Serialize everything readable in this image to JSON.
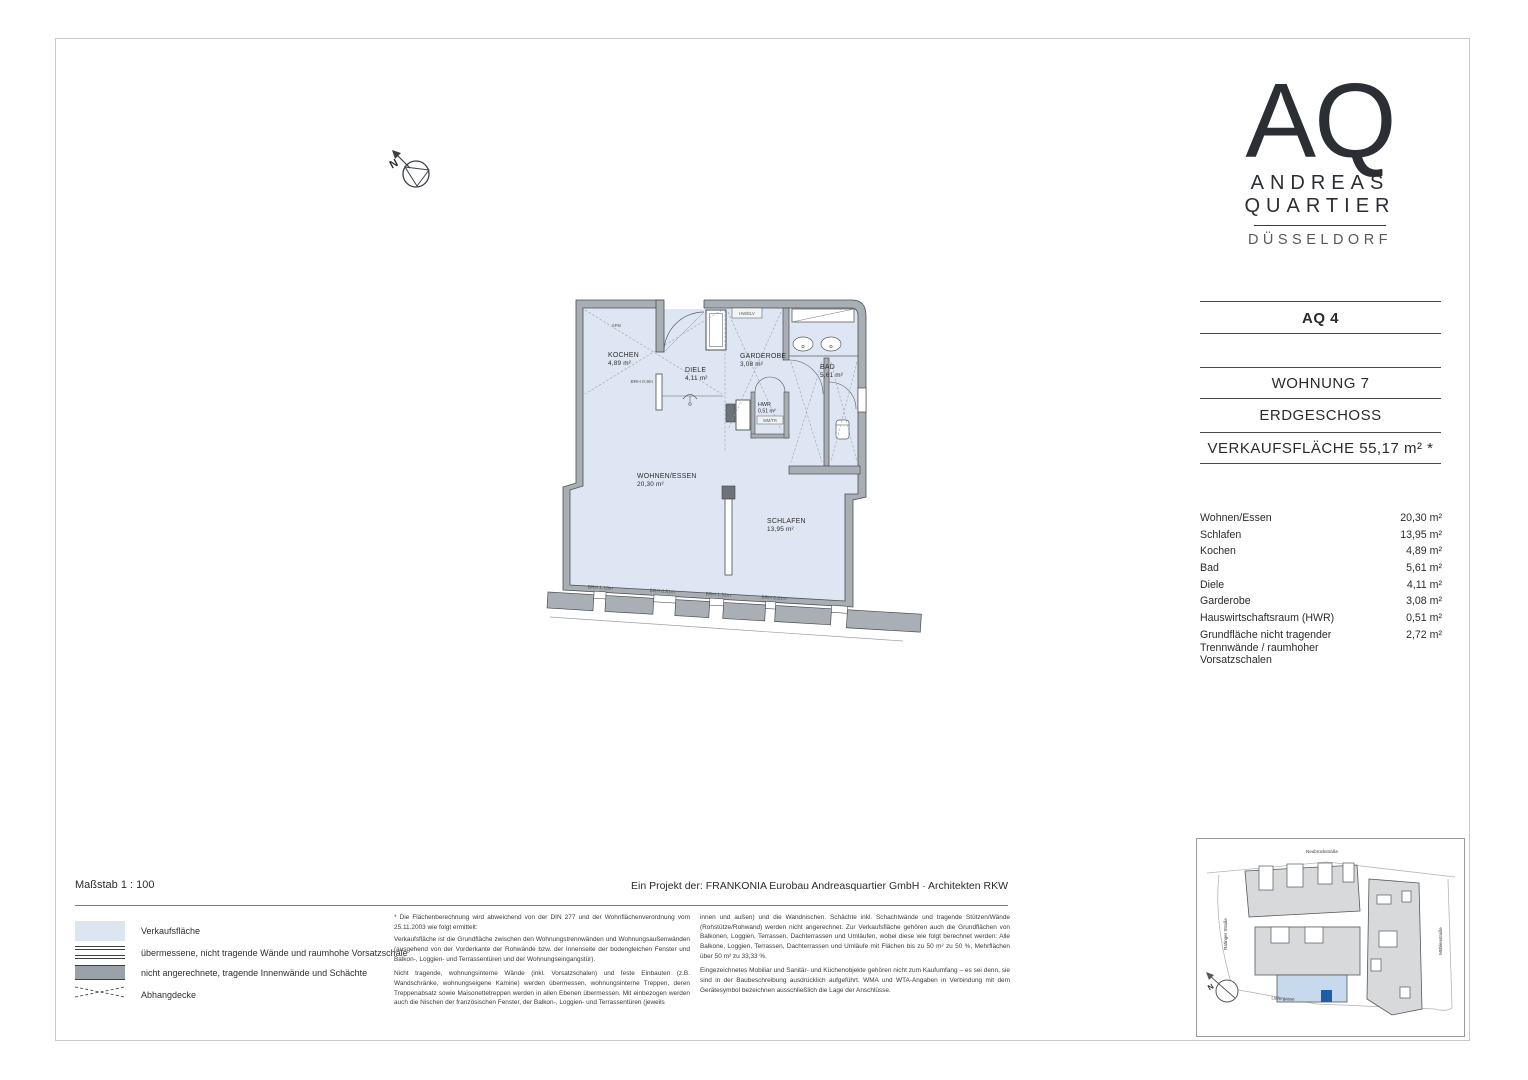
{
  "document": {
    "scale_label": "Maßstab 1 : 100",
    "project_credit": "Ein Projekt der: FRANKONIA Eurobau Andreasquartier GmbH · Architekten RKW"
  },
  "logo": {
    "monogram": "AQ",
    "name_line1": "ANDREAS",
    "name_line2": "QUARTIER",
    "city": "DÜSSELDORF"
  },
  "title_block": {
    "building": "AQ 4",
    "unit": "WOHNUNG 7",
    "floor": "ERDGESCHOSS",
    "sales_area": "VERKAUFSFLÄCHE 55,17 m² *"
  },
  "room_table": {
    "rows": [
      {
        "label": "Wohnen/Essen",
        "value": "20,30 m²"
      },
      {
        "label": "Schlafen",
        "value": "13,95 m²"
      },
      {
        "label": "Kochen",
        "value": "4,89 m²"
      },
      {
        "label": "Bad",
        "value": "5,61 m²"
      },
      {
        "label": "Diele",
        "value": "4,11 m²"
      },
      {
        "label": "Garderobe",
        "value": "3,08 m²"
      },
      {
        "label": "Hauswirtschaftsraum (HWR)",
        "value": "0,51 m²"
      },
      {
        "label": "Grundfläche nicht tragender Trennwände / raumhoher Vorsatzschalen",
        "value": "2,72 m²"
      }
    ]
  },
  "floor_plan": {
    "north": "N",
    "rooms": [
      {
        "name": "KOCHEN",
        "area": "4,89 m²"
      },
      {
        "name": "DIELE",
        "area": "4,11 m²"
      },
      {
        "name": "GARDEROBE",
        "area": "3,08 m²"
      },
      {
        "name": "BAD",
        "area": "5,61 m²"
      },
      {
        "name": "HWR",
        "area": "0,51 m²"
      },
      {
        "name": "WOHNEN/ESSEN",
        "area": "20,30 m²"
      },
      {
        "name": "SCHLAFEN",
        "area": "13,95 m²"
      }
    ],
    "annotations": {
      "spm": "SPM",
      "hw_elv": "HW/ELV",
      "wm_tr": "WM/TR",
      "kitchen_brh": "BRH 0.9m"
    },
    "window_labels": [
      "BRH 1.10m",
      "BRH 0.81m",
      "BRH 1.32m",
      "BRH 0.81m"
    ]
  },
  "legend": {
    "items": [
      {
        "label": "Verkaufsfläche"
      },
      {
        "label": "übermessene, nicht tragende Wände und raumhohe Vorsatzschale"
      },
      {
        "label": "nicht angerechnete, tragende Innenwände und Schächte"
      },
      {
        "label": "Abhangdecke"
      }
    ]
  },
  "footnotes": {
    "col1": [
      "* Die Flächenberechnung wird abweichend von der DIN 277 und der Wohnflächenverordnung vom 25.11.2003 wie folgt ermittelt:",
      "Verkaufsfläche ist die Grundfläche zwischen den Wohnungstrennwänden und Wohnungsaußenwänden (ausgehend von der Vorderkante der Rohwände bzw. der Innenseite der bodengleichen Fenster und Balkon-, Loggien- und Terrassentüren und der Wohnungseingangstür).",
      "Nicht tragende, wohnungsinterne Wände (inkl. Vorsatzschalen) und feste Einbauten (z.B. Wandschränke, wohnungseigene Kamine) werden übermessen, wohnungsinterne Treppen, deren Treppenabsatz sowie Maisonettetreppen werden in allen Ebenen übermessen. Mit einbezogen werden auch die Nischen der französischen Fenster, der Balkon-, Loggien- und Terrassentüren (jeweils"
    ],
    "col2": [
      "innen und außen) und die Wandnischen. Schächte inkl. Schachtwände und tragende Stützen/Wände (Rohstütze/Rohwand) werden nicht angerechnet. Zur Verkaufsfläche gehören auch die Grundflächen von Balkonen, Loggien, Terrassen, Dachterrassen und Umläufen, wobei diese wie folgt berechnet werden: Alle Balkone, Loggien, Terrassen, Dachterrassen und Umläufe mit Flächen bis zu 50 m² zu 50 %, Mehrflächen über 50 m² zu 33,33 %.",
      "Eingezeichnetes Mobiliar und Sanitär- und Küchenobjekte gehören nicht zum Kaufumfang – es sei denn, sie sind in der Baubeschreibung ausdrücklich aufgeführt. WMA und WTA-Angaben in Verbindung mit dem Gerätesymbol bezeichnen ausschließlich die Lage der Anschlüsse."
    ]
  },
  "site_map": {
    "north": "N",
    "streets": {
      "top": "Neubrückstraße",
      "left": "Ratinger Straße",
      "right": "Mühlenstraße",
      "bottom": "Liefergasse"
    }
  },
  "colors": {
    "sales_area_fill": "#dde6f2",
    "wall_fill": "#a9aeb4",
    "map_highlight": "#c7d9ed",
    "map_unit_marker": "#1e5ea8"
  }
}
